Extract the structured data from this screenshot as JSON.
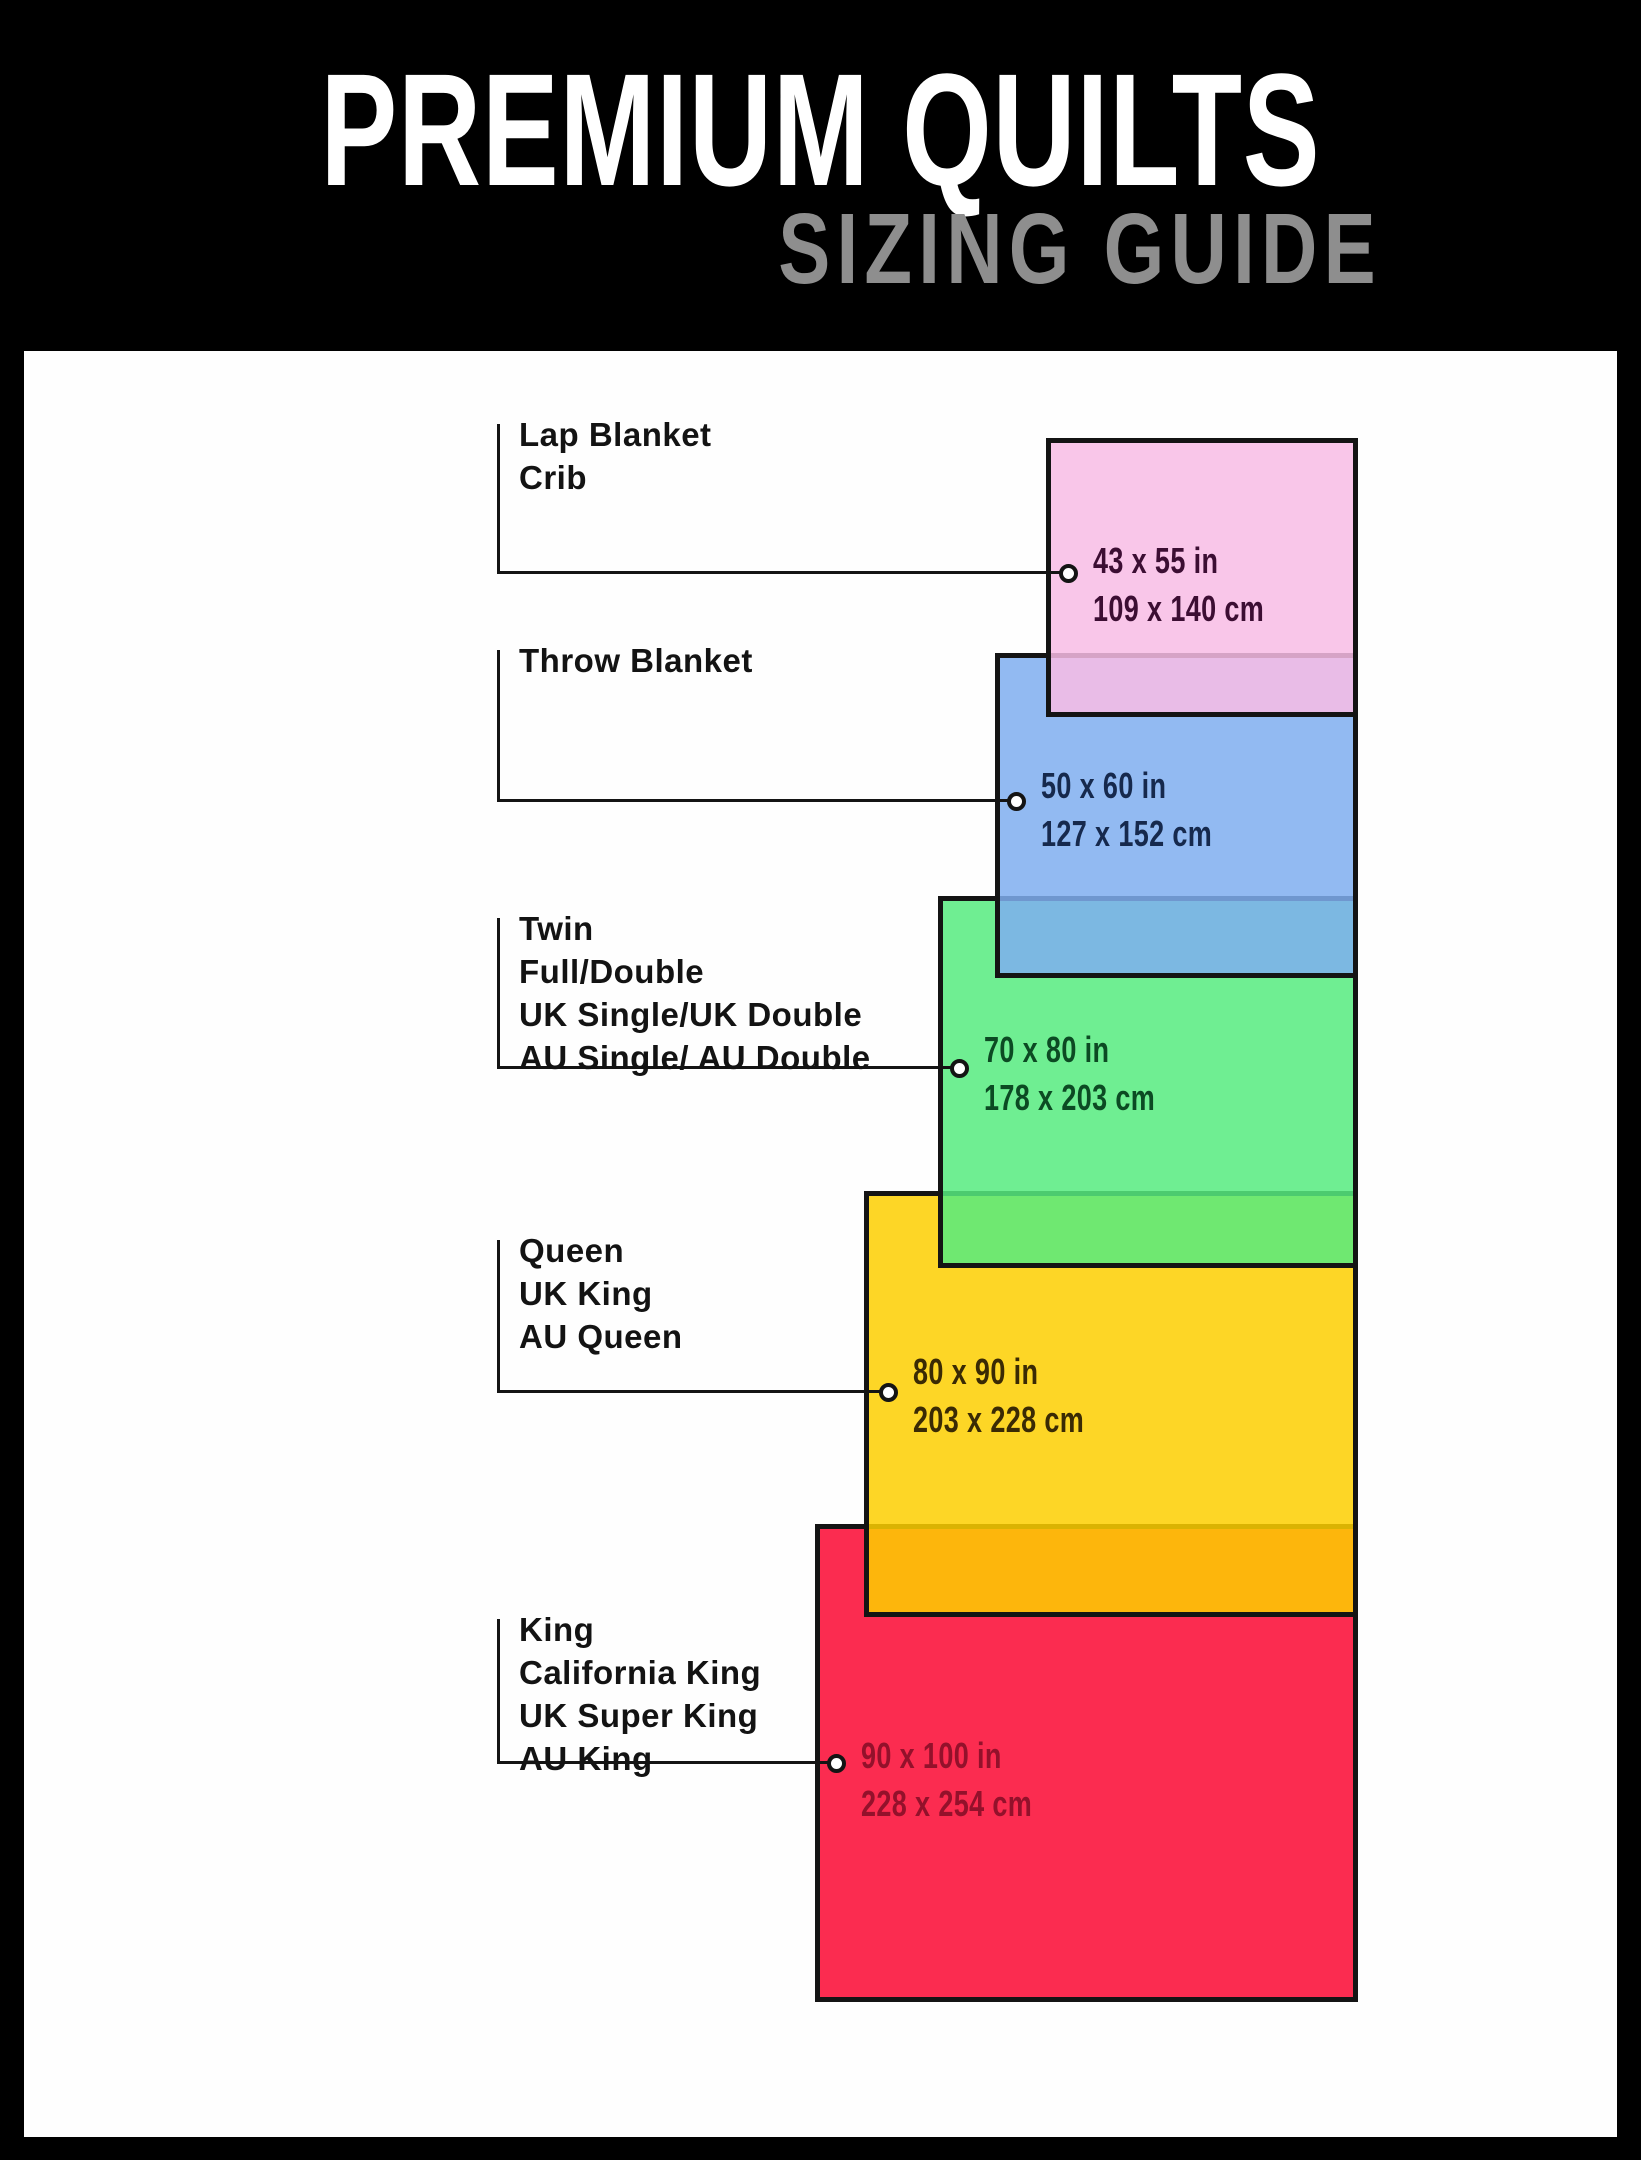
{
  "header": {
    "title": "PREMIUM QUILTS",
    "subtitle": "SIZING GUIDE",
    "background": "#000000",
    "title_color": "#ffffff",
    "subtitle_color": "#8e8e8e"
  },
  "canvas_background": "#fefefe",
  "styles": {
    "rect_border_color": "#141414",
    "connector_color": "#141414",
    "label_color": "#131313",
    "dot_fill": "#ffffff"
  },
  "sizes": [
    {
      "id": "lap-blanket-crib",
      "labels": [
        "Lap Blanket",
        "Crib"
      ],
      "size_in": "43 x 55 in",
      "size_cm": "109 x 140 cm",
      "fill": "#f9c6e9",
      "fill_rgba": "rgba(248,188,229,0.85)",
      "dimension_text_color": "#3c0e33"
    },
    {
      "id": "throw-blanket",
      "labels": [
        "Throw Blanket"
      ],
      "size_in": "50 x 60 in",
      "size_cm": "127 x 152 cm",
      "fill": "#92baf2",
      "fill_rgba": "rgba(127,174,240,0.85)",
      "dimension_text_color": "#16294d"
    },
    {
      "id": "twin-full-double",
      "labels": [
        "Twin",
        "Full/Double",
        "UK Single/UK Double",
        "AU Single/ AU Double"
      ],
      "size_in": "70 x 80 in",
      "size_cm": "178 x 203 cm",
      "fill": "#6fee92",
      "fill_rgba": "rgba(86,235,127,0.85)",
      "dimension_text_color": "#0c4a23"
    },
    {
      "id": "queen-uk-king-au-queen",
      "labels": [
        "Queen",
        "UK King",
        "AU Queen"
      ],
      "size_in": "80 x 90 in",
      "size_cm": "203 x 228 cm",
      "fill": "#fdd60d",
      "fill_rgba": "rgba(253,207,0,0.85)",
      "dimension_text_color": "#3a2a04"
    },
    {
      "id": "king-california-king",
      "labels": [
        "King",
        "California King",
        "UK Super King",
        "AU King"
      ],
      "size_in": "90 x 100 in",
      "size_cm": "228 x 254 cm",
      "fill": "#fb2c50",
      "fill_rgba": "rgba(250,7,49,0.85)",
      "dimension_text_color": "#93112b"
    }
  ]
}
